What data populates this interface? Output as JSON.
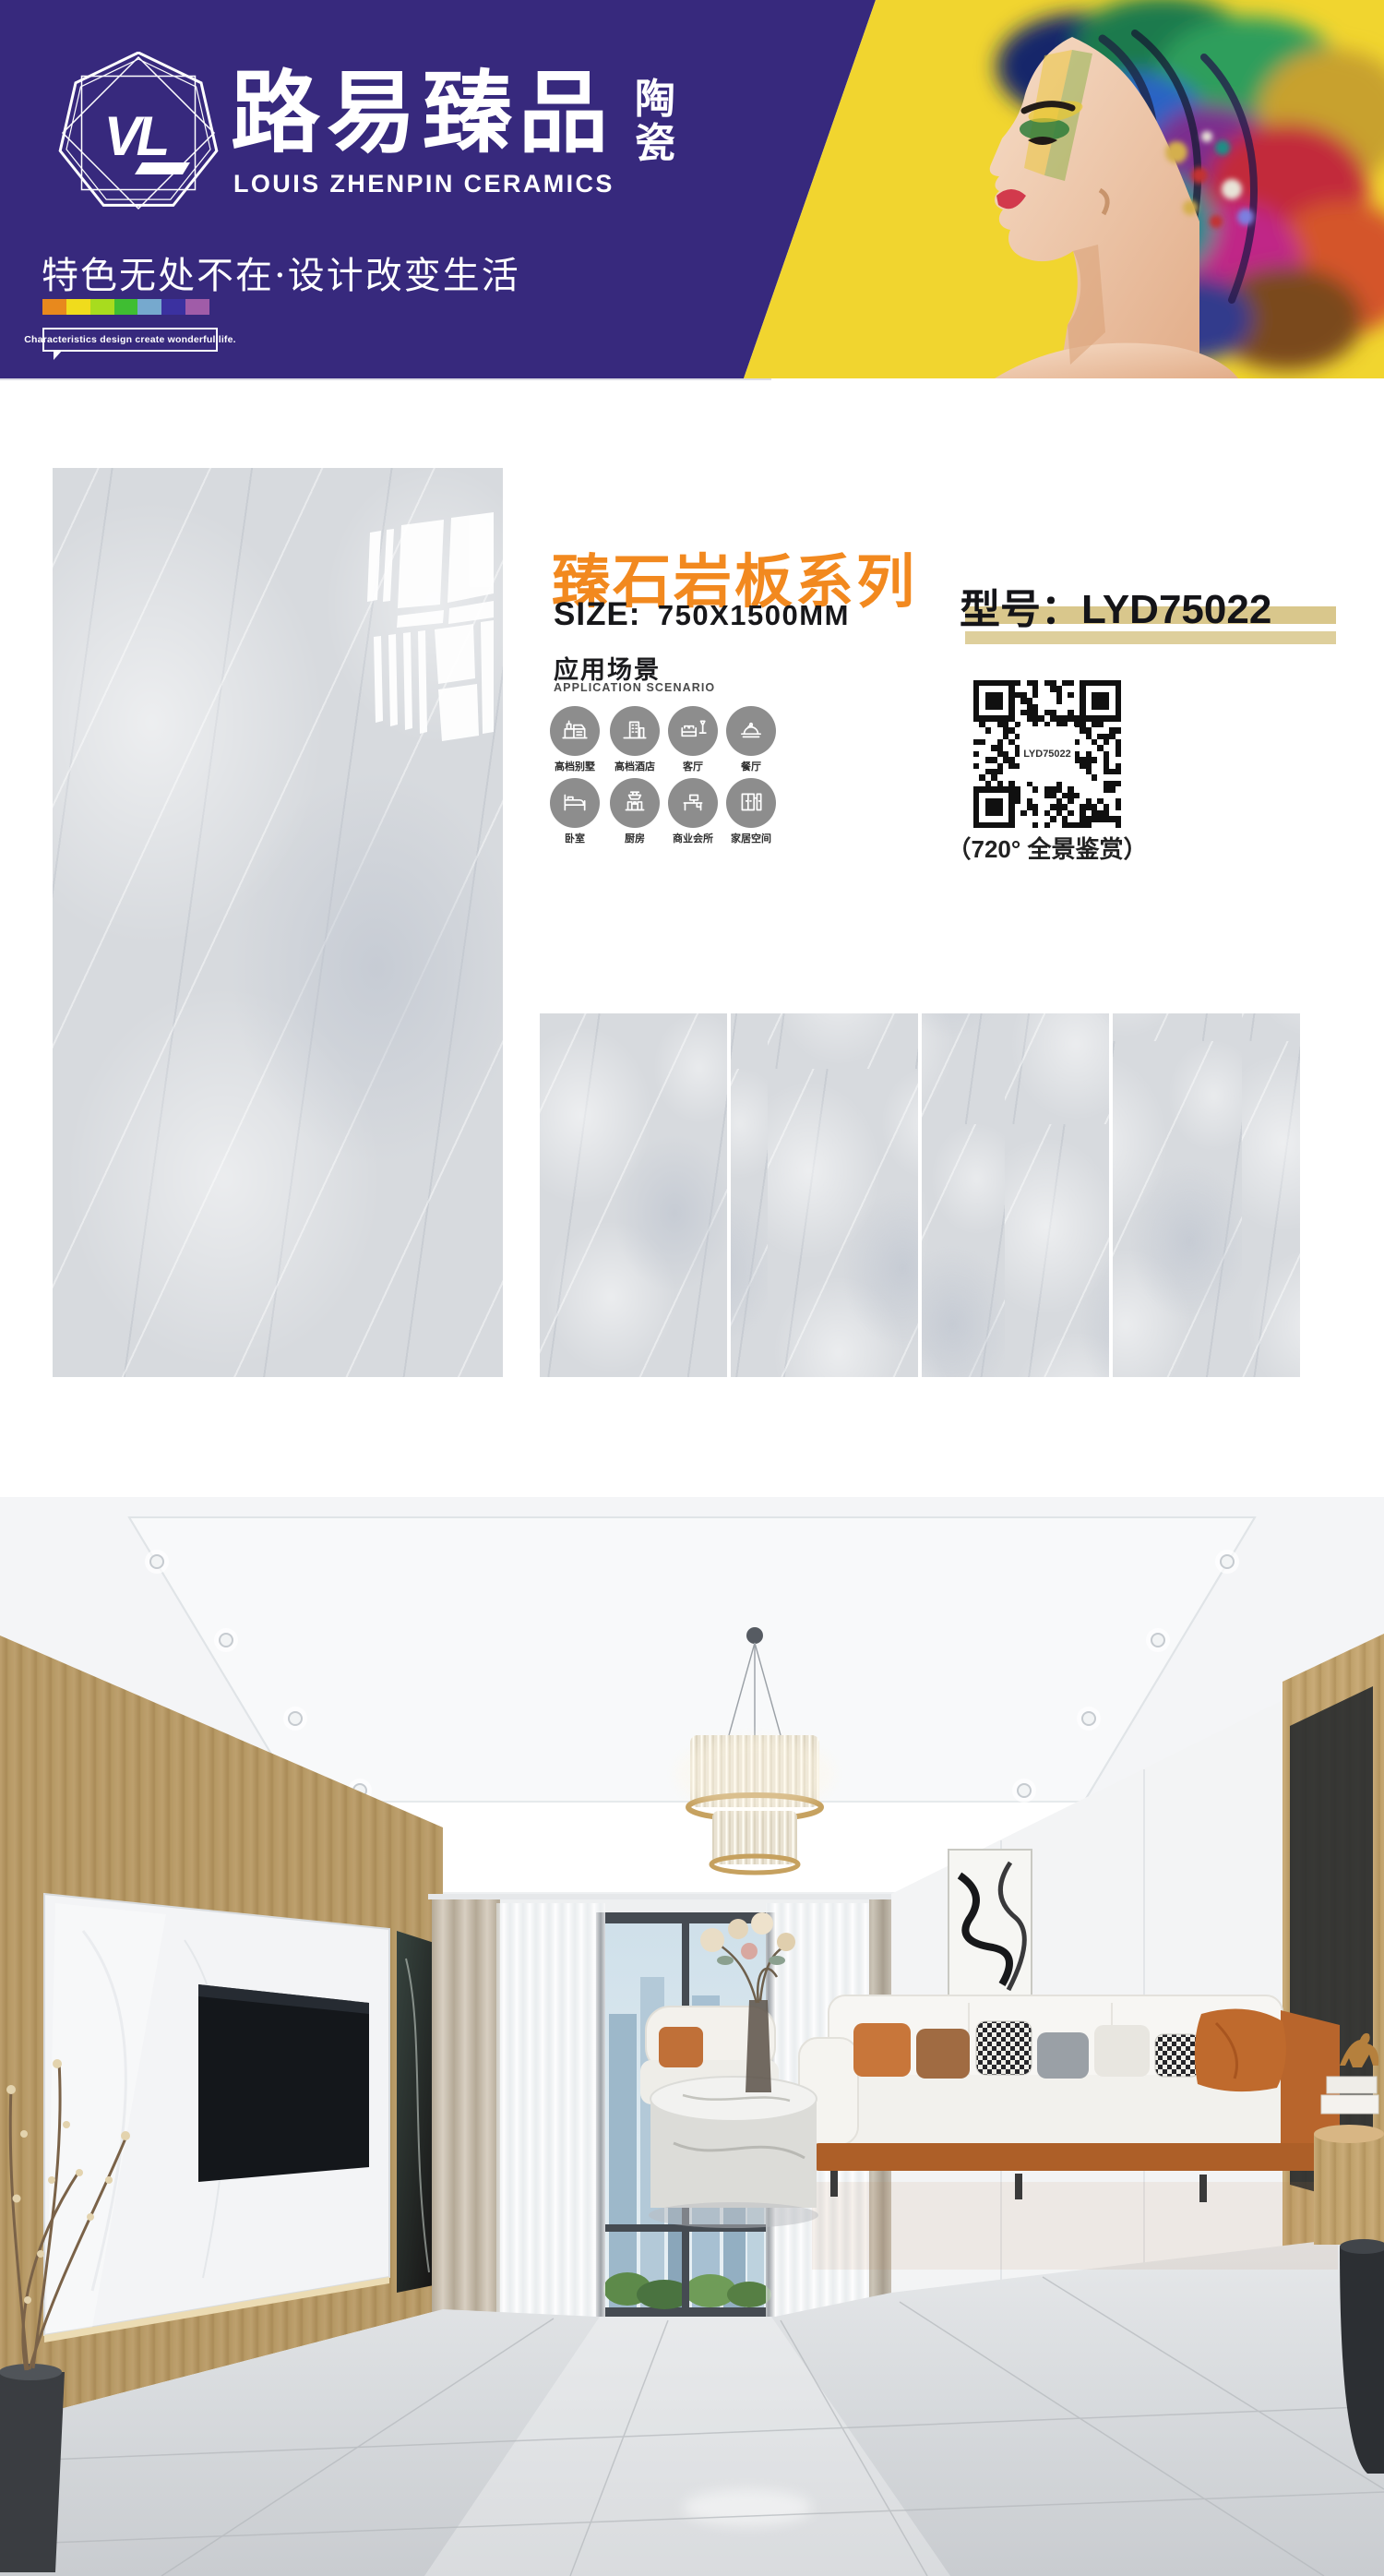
{
  "header": {
    "logo": {
      "monogram": "VL"
    },
    "brand_cn": "路易臻品",
    "brand_suffix_top": "陶",
    "brand_suffix_bottom": "瓷",
    "brand_en": "LOUIS ZHENPIN CERAMICS",
    "slogan_cn": "特色无处不在·设计改变生活",
    "slogan_en": "Characteristics design create wonderful life.",
    "colors": {
      "purple": "#37297D",
      "yellow": "#F1D52F",
      "rainbow": [
        "#E8891D",
        "#F0DC1C",
        "#A8DC1E",
        "#3FBE32",
        "#76A9CE",
        "#3B31A0",
        "#A05CA8"
      ]
    }
  },
  "product": {
    "series_title": "臻石岩板系列",
    "size_label": "SIZE:",
    "size_value": "750X1500MM",
    "model_label": "型号：",
    "model_value": "LYD75022",
    "scenario_title": "应用场景",
    "scenario_subtitle": "APPLICATION SCENARIO",
    "scenarios": [
      {
        "label": "高档别墅",
        "icon": "villa-icon"
      },
      {
        "label": "高档酒店",
        "icon": "hotel-icon"
      },
      {
        "label": "客厅",
        "icon": "living-room-icon"
      },
      {
        "label": "餐厅",
        "icon": "dining-room-icon"
      },
      {
        "label": "卧室",
        "icon": "bedroom-icon"
      },
      {
        "label": "厨房",
        "icon": "kitchen-icon"
      },
      {
        "label": "商业会所",
        "icon": "commercial-club-icon"
      },
      {
        "label": "家居空间",
        "icon": "home-space-icon"
      }
    ],
    "qr": {
      "center_text": "LYD75022",
      "caption": "（720° 全景鉴赏）"
    },
    "accent_orange": "#F2891F",
    "bar_tan": "#D9C78C"
  }
}
